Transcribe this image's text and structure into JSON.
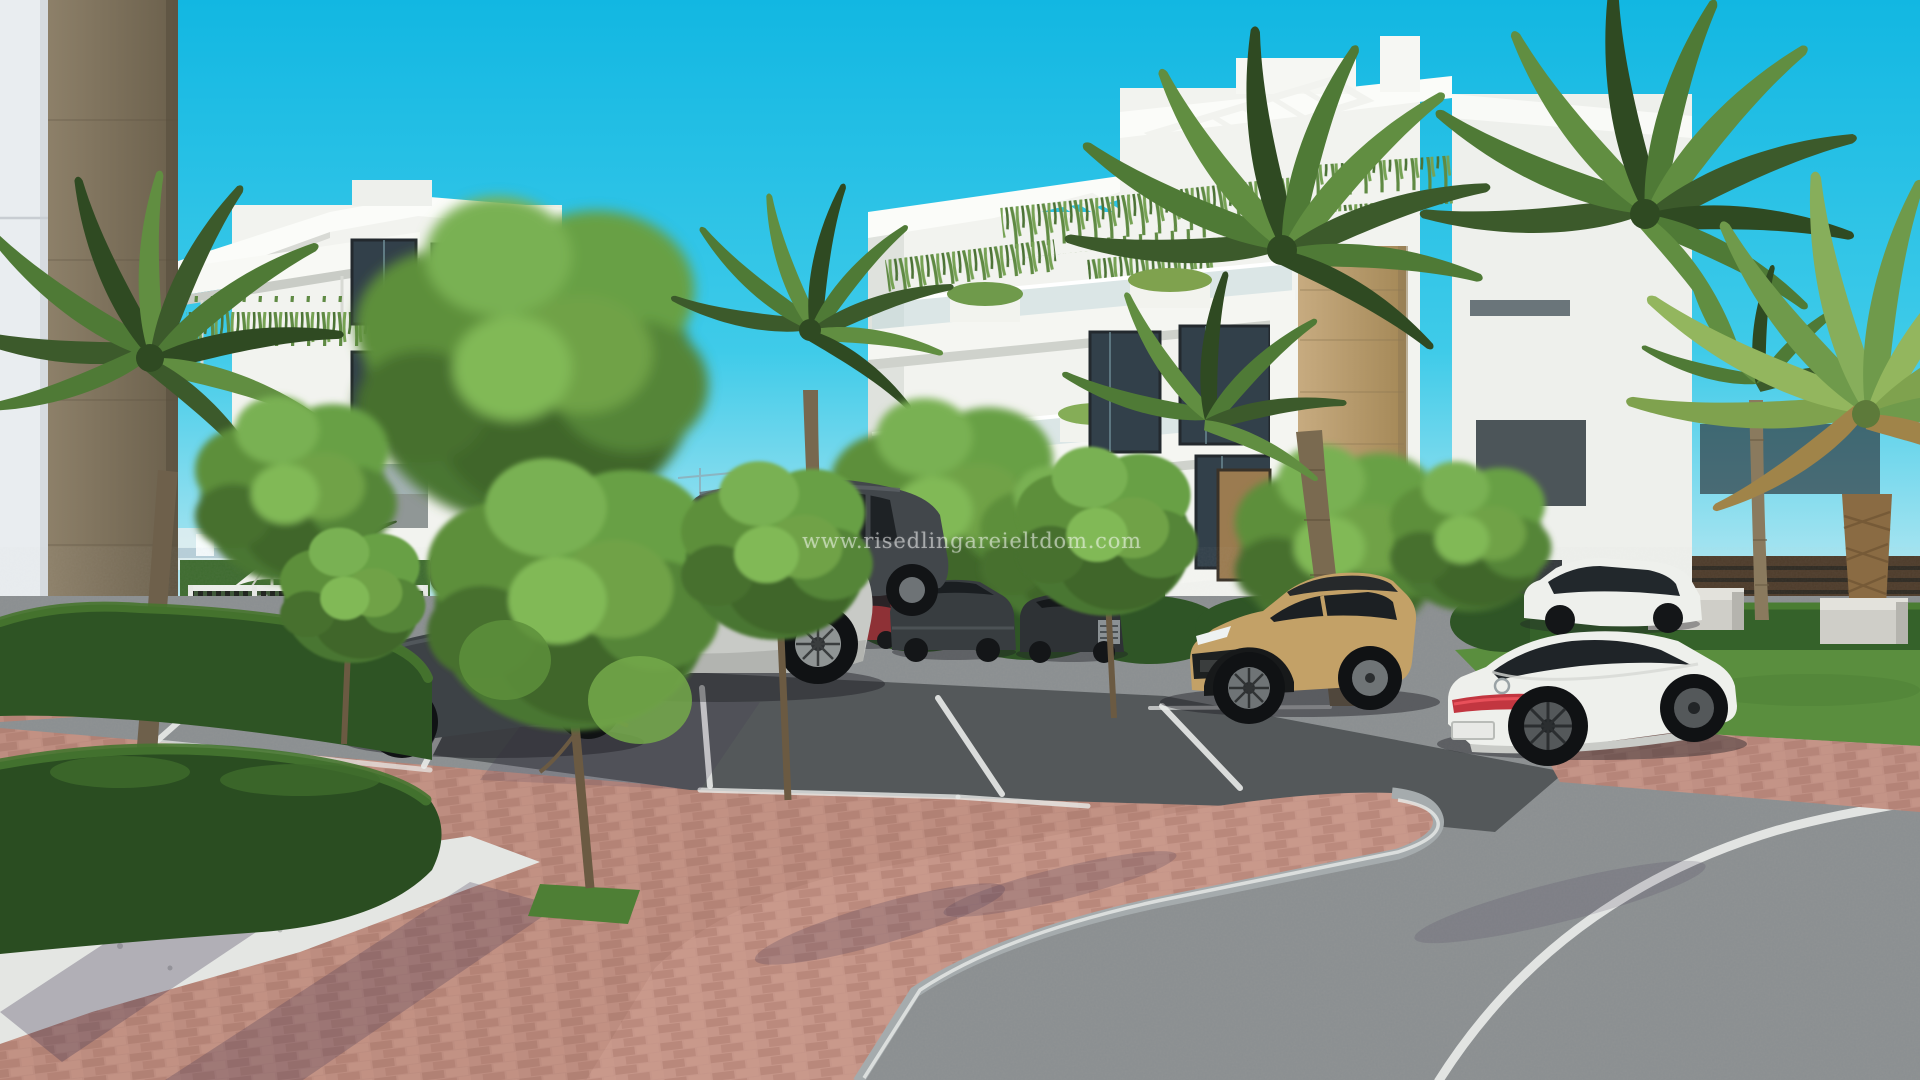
{
  "meta": {
    "scene_type": "3D architectural exterior render",
    "description": "New-build white apartment complex with palm trees, landscaped brick parking area, curved asphalt road and parked cars under a clear cyan sky"
  },
  "watermark": {
    "text": "www.risedlingareieltdom.com"
  },
  "colors": {
    "sky-top": "#12b7e2",
    "sky-mid": "#3fcbe9",
    "sky-horizon": "#cfeef3",
    "mountain": "#a8c2d3",
    "building-white": "#f2f3ef",
    "building-bright": "#fbfcf9",
    "building-shade": "#dfe2dd",
    "stone-beige": "#bb9d71",
    "timber-brown": "#83765f",
    "glass-dark": "#32404a",
    "hedge-green": "#2e5424",
    "hedge-light": "#4a7a31",
    "tree-green": "#4a7631",
    "tree-light": "#74a94a",
    "lawn-green": "#5a8e3e",
    "asphalt": "#8a8e90",
    "asphalt-dark": "#54585a",
    "brick": "#bd8d80",
    "brick-island": "#c69689",
    "gravel": "#e4e6e3",
    "line-white": "#e9ebe9",
    "car-silver": "#c8cac6",
    "car-dark": "#3d4246",
    "car-tan": "#c3a167",
    "car-white": "#eef0ec",
    "car-red": "#8e3136",
    "taillight-red": "#c23640",
    "fence-dark": "#23261f",
    "fence-brown": "#4e3c2b"
  },
  "scene": {
    "sky": "clear cyan sky",
    "background": {
      "mountains": "hazy blue mountain ridges",
      "city": "distant low-rise white buildings with cranes",
      "perimeter": "white perimeter wall with dark slatted fence"
    },
    "buildings": [
      {
        "label": "foreground wall with timber-look pillar",
        "position": "far left"
      },
      {
        "label": "white 4-storey apartment block with planted balcony",
        "position": "left"
      },
      {
        "label": "white 4-storey apartment block with roof pergolas, hanging plants and beige stone feature wall",
        "position": "right"
      },
      {
        "label": "white building corner behind palms",
        "position": "far right"
      }
    ],
    "amenities": [
      "pool area with white parasol and sun loungers behind dark slatted fence",
      "trimmed boxwood hedges",
      "white gravel bed",
      "concrete benches on lawn"
    ],
    "vehicles": [
      {
        "type": "sedan",
        "color": "dark grey",
        "position": "left parking row"
      },
      {
        "type": "suv",
        "color": "silver",
        "position": "centre parking row"
      },
      {
        "type": "minivan",
        "color": "graphite",
        "position": "behind silver suv"
      },
      {
        "type": "sedan",
        "color": "white",
        "position": "distant road behind hedge"
      },
      {
        "type": "compact suv",
        "color": "red",
        "position": "middle distance"
      },
      {
        "type": "suv",
        "color": "dark grey",
        "position": "middle distance"
      },
      {
        "type": "hatchback",
        "color": "black",
        "position": "middle distance"
      },
      {
        "type": "crossover",
        "color": "sand beige, black roof",
        "position": "right parking row"
      },
      {
        "type": "coupe",
        "color": "white",
        "position": "far right behind lawn"
      },
      {
        "type": "fastback sedan",
        "color": "white",
        "position": "right foreground"
      }
    ],
    "ground": [
      "red clay brick paving",
      "dark asphalt parking bays with white lines",
      "curved asphalt road with white edge line",
      "raised brick median island with grey curb",
      "lawn strips and young trees"
    ]
  }
}
